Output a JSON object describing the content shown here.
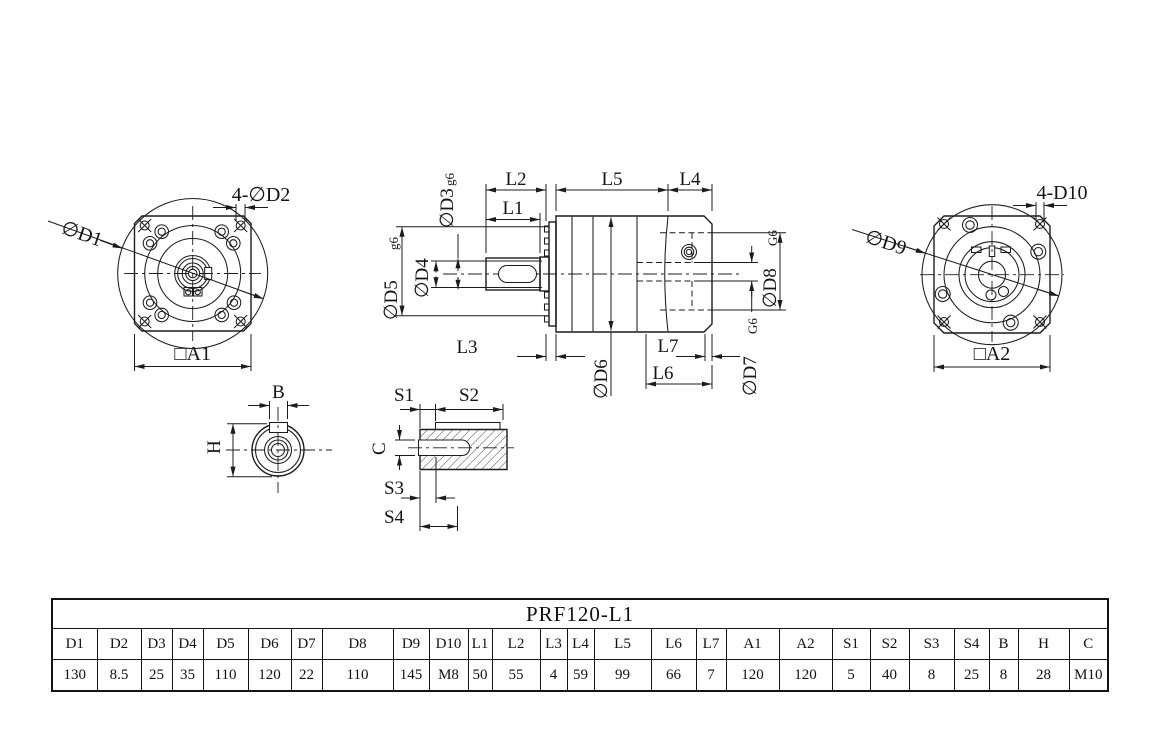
{
  "views": {
    "front_flange": {
      "dia_label": "∅D1",
      "holes_label": "4-∅D2",
      "square_label": "□A1"
    },
    "side_section": {
      "d3": "∅D3",
      "d3_fit": "g6",
      "d4": "∅D4",
      "d5": "∅D5",
      "d5_fit": "g6",
      "d6": "∅D6",
      "d7": "∅D7",
      "d7_fit": "G6",
      "d8": "∅D8",
      "d8_fit": "G6",
      "l1": "L1",
      "l2": "L2",
      "l3": "L3",
      "l4": "L4",
      "l5": "L5",
      "l6": "L6",
      "l7": "L7"
    },
    "rear_flange": {
      "dia_label": "∅D9",
      "holes_label": "4-D10",
      "square_label": "□A2"
    },
    "shaft_key_section": {
      "width_label": "B",
      "height_label": "H"
    },
    "key_detail": {
      "s1": "S1",
      "s2": "S2",
      "s3": "S3",
      "s4": "S4",
      "c": "C"
    }
  },
  "table": {
    "title": "PRF120-L1",
    "columns": [
      "D1",
      "D2",
      "D3",
      "D4",
      "D5",
      "D6",
      "D7",
      "D8",
      "D9",
      "D10",
      "L1",
      "L2",
      "L3",
      "L4",
      "L5",
      "L6",
      "L7",
      "A1",
      "A2",
      "S1",
      "S2",
      "S3",
      "S4",
      "B",
      "H",
      "C"
    ],
    "values": [
      "130",
      "8.5",
      "25",
      "35",
      "110",
      "120",
      "22",
      "110",
      "145",
      "M8",
      "50",
      "55",
      "4",
      "59",
      "99",
      "66",
      "7",
      "120",
      "120",
      "5",
      "40",
      "8",
      "25",
      "8",
      "28",
      "M10"
    ]
  }
}
